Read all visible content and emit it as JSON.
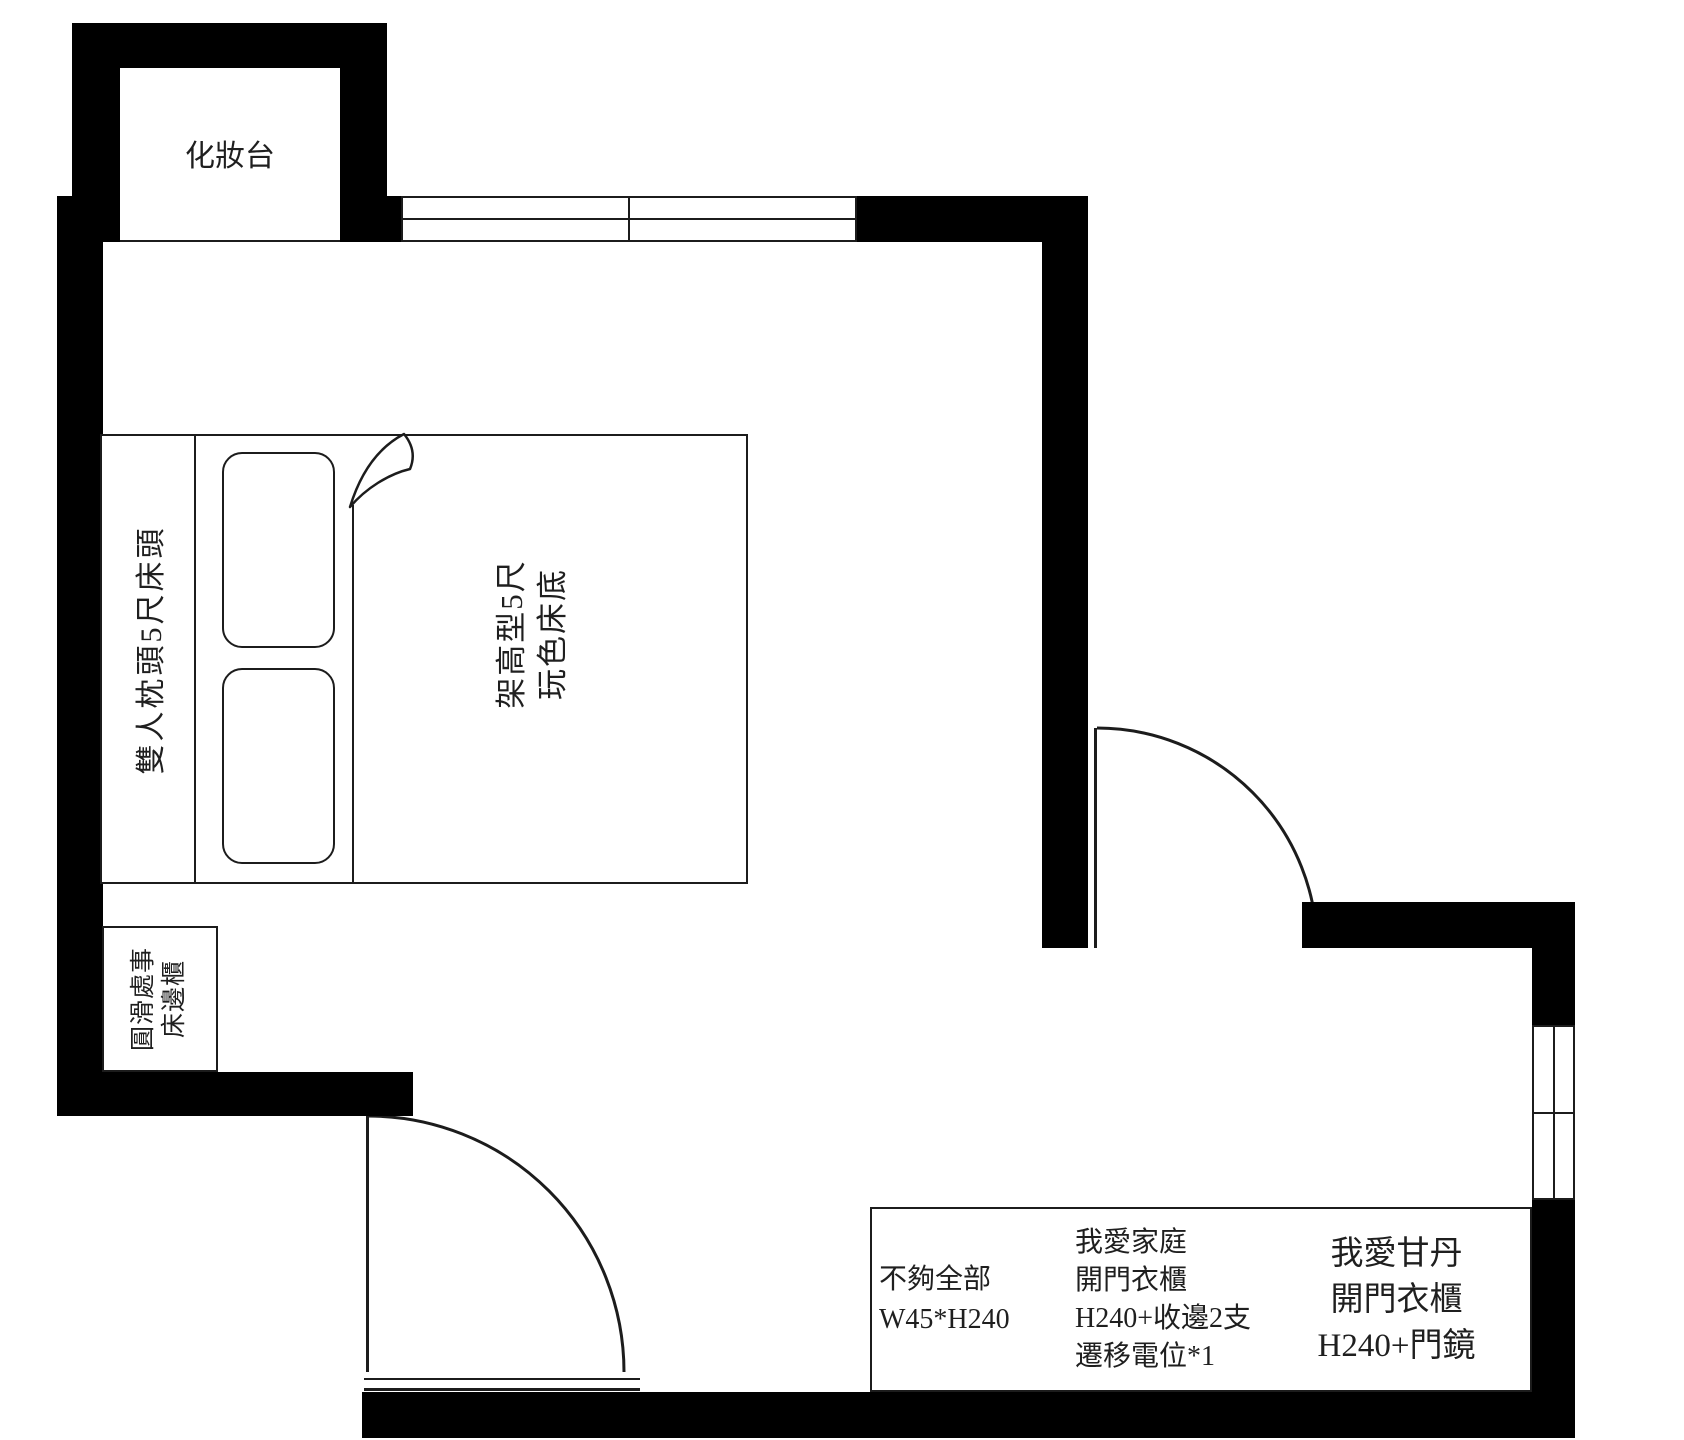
{
  "plan": {
    "vanity_label": "化妝台",
    "bed": {
      "headboard_label": "雙人枕頭5尺床頭",
      "base_lines": [
        "架高型5尺",
        "玩色床底"
      ]
    },
    "side_cabinet_lines": [
      "圓滑處事",
      "床邊櫃"
    ],
    "wardrobe_boxes": [
      {
        "lines": [
          "不夠全部",
          "W45*H240"
        ]
      },
      {
        "lines": [
          "我愛家庭",
          "開門衣櫃",
          "H240+收邊2支",
          "遷移電位*1"
        ]
      },
      {
        "lines": [
          "我愛甘丹",
          "開門衣櫃",
          "H240+門鏡"
        ]
      }
    ],
    "colors": {
      "wall": "#000000",
      "line": "#1c1c1c",
      "text": "#1f1f1f",
      "background": "#ffffff"
    }
  }
}
